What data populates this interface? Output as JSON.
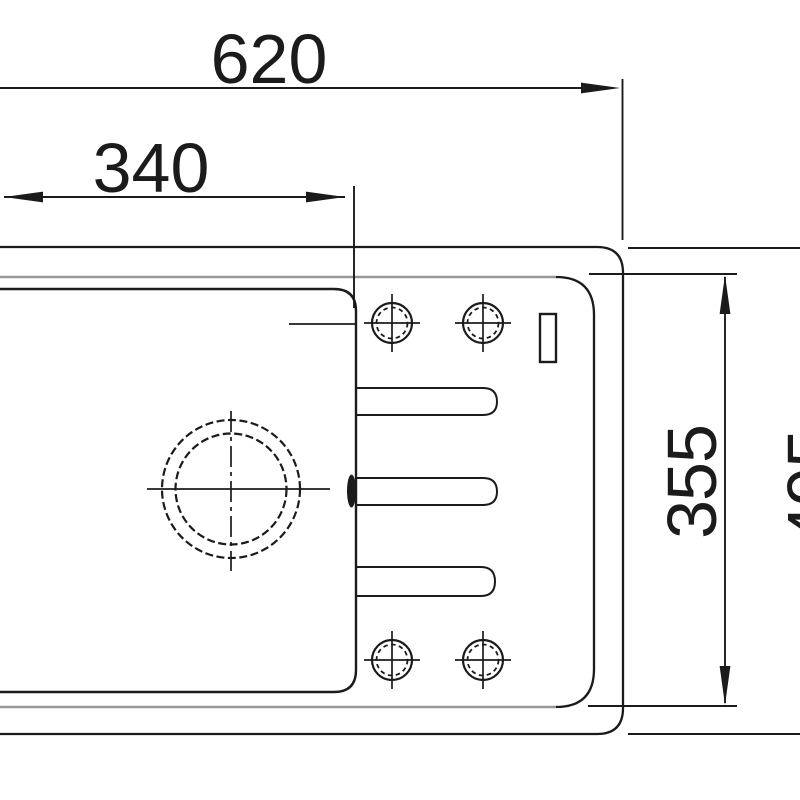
{
  "drawing": {
    "type": "sink-top-view-dimension-drawing",
    "background_color": "#ffffff",
    "line_color": "#1b1b1b",
    "secondary_line_color": "#979797",
    "dimensions": {
      "overall_width": "620",
      "bowl_width": "340",
      "inner_depth": "355",
      "right_depth_partial": "495"
    }
  }
}
